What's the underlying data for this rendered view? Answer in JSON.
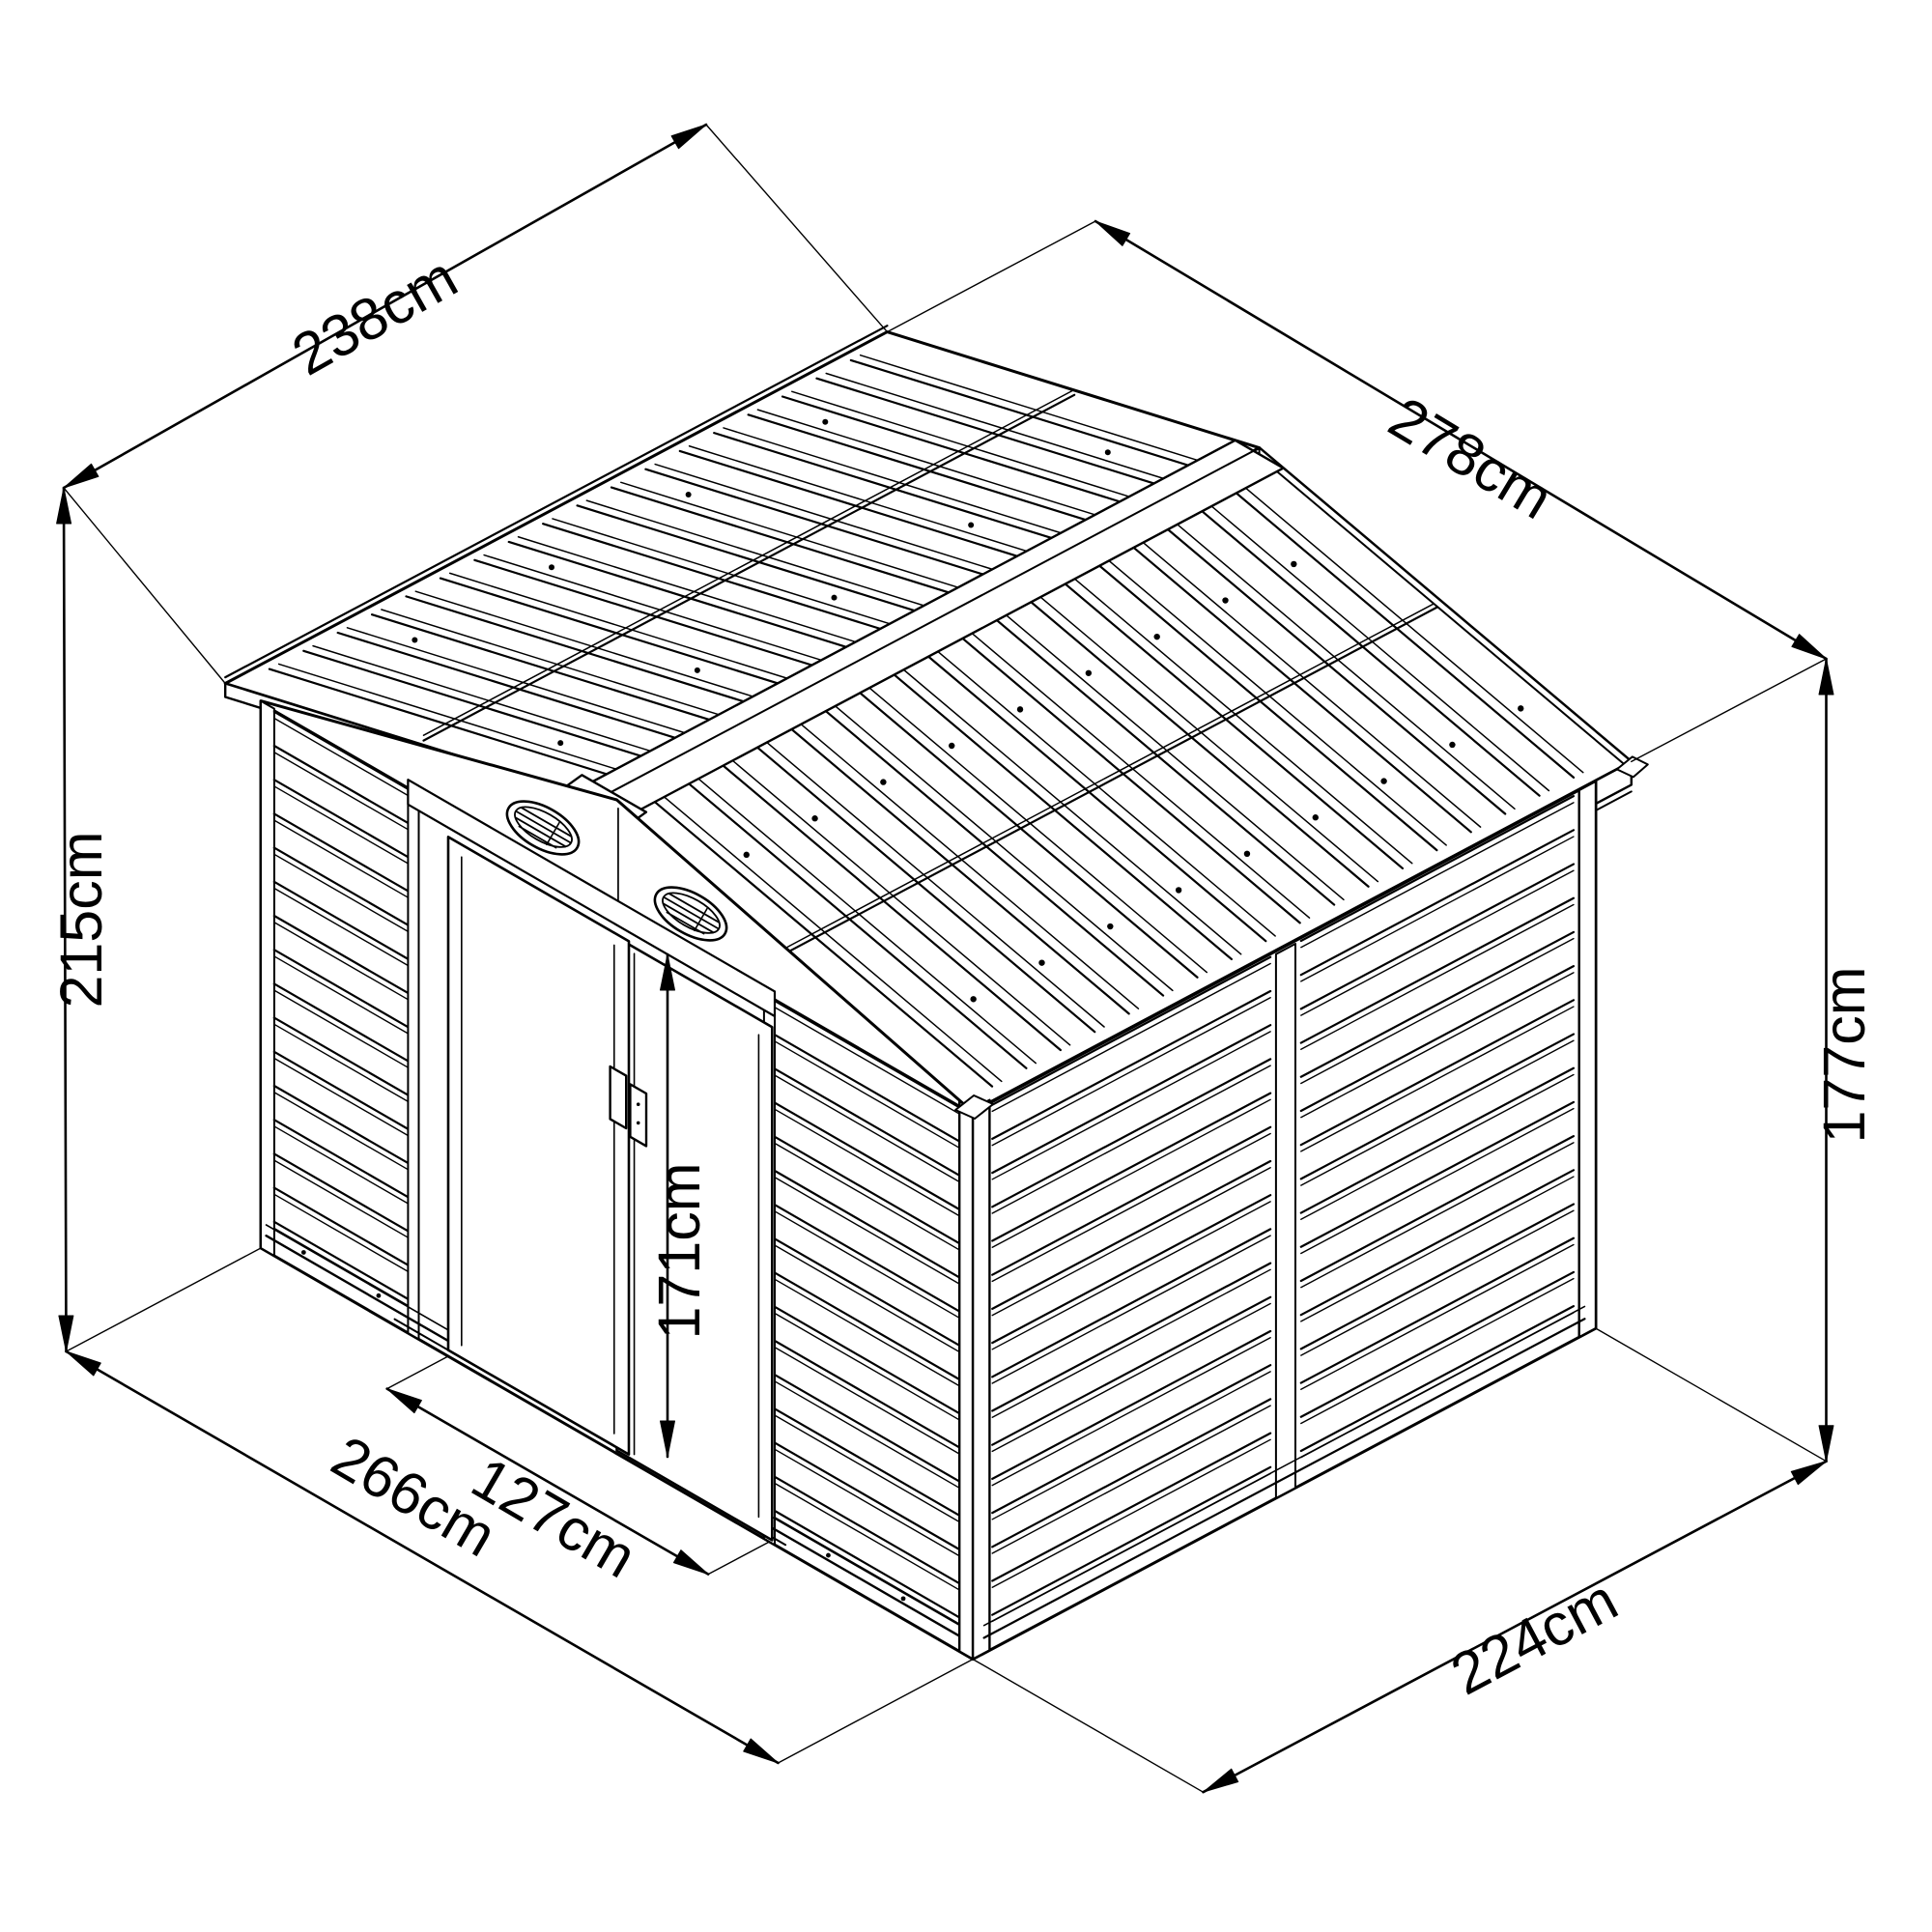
{
  "dimensions": {
    "roof_depth": "238cm",
    "roof_width": "278cm",
    "overall_height": "215cm",
    "wall_height": "177cm",
    "door_height": "171cm",
    "door_width": "127cm",
    "base_width": "266cm",
    "base_depth": "224cm"
  },
  "colors": {
    "line": "#000000",
    "background": "#ffffff"
  }
}
